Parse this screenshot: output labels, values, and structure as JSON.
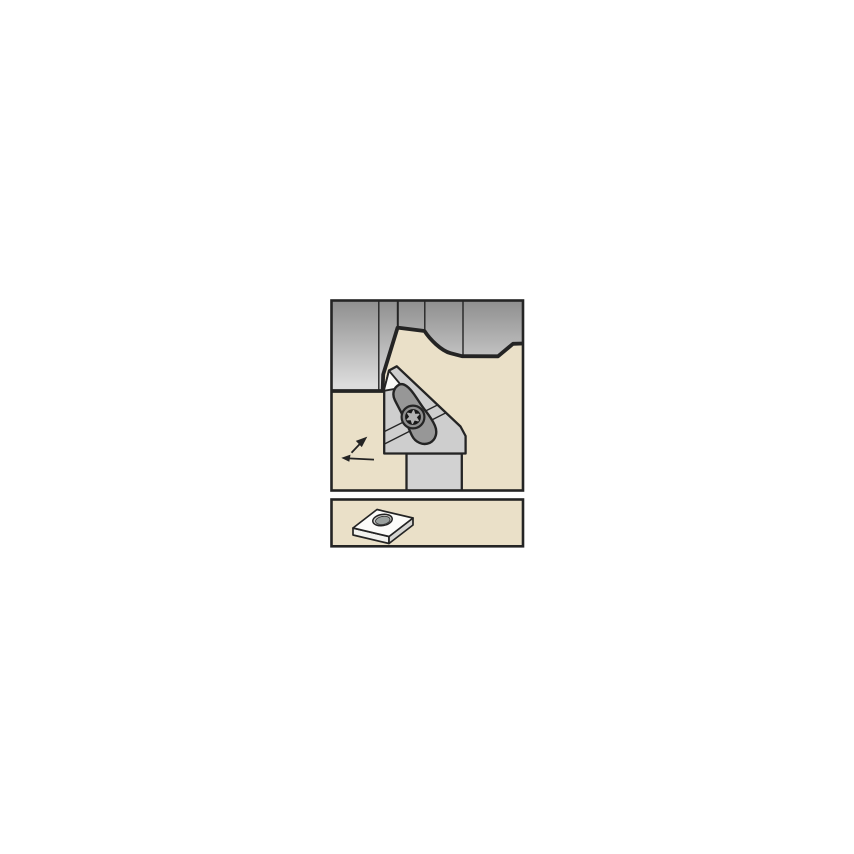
{
  "figure": {
    "kind": "tool-catalog-illustration",
    "labels": {
      "main_panel": "turning application view",
      "insert_panel": "insert view",
      "workpiece": "profiled workpiece",
      "holder": "tool holder",
      "clamp": "insert top clamp",
      "screw": "torx clamp screw",
      "insert_tip": "cutting insert tip",
      "feed_arrows": "feed direction arrows",
      "insert_3d": "rhombic diamond insert with center hole"
    }
  },
  "colors": {
    "page_bg": "#ffffff",
    "panel_bg": "#eae0c8",
    "line": "#242424",
    "steel_top": "#8f8f8f",
    "steel_bottom": "#dcdcdc",
    "holder_gray": "#cecece",
    "shank_gray": "#d2d2d2",
    "clamp_gray": "#979797",
    "insert_white": "#f9f9f7",
    "screw_ring": "#8f8f8f",
    "screw_core": "#181818",
    "screw_star": "#b2b2b2",
    "insert_top": "#fcfcfa",
    "insert_side_left": "#f2f2ef",
    "insert_side_right": "#d6d6d3",
    "hole_rim": "#cbcbc8",
    "hole_bore": "#9aa09e"
  }
}
